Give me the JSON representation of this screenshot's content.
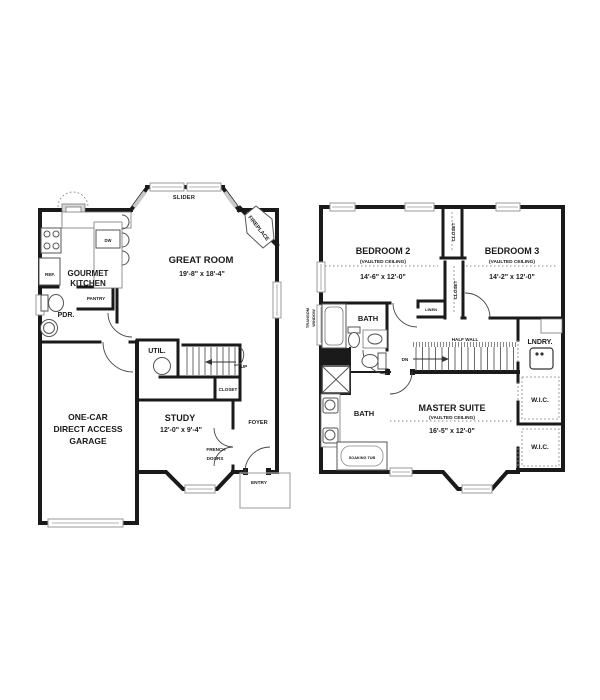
{
  "colors": {
    "wall": "#1a1a1a",
    "window_gray": "#c9c9c9",
    "fixture_gray": "#d9d9d9"
  },
  "floor1": {
    "slider": "SLIDER",
    "fireplace": "FIREPLACE",
    "great_room": {
      "name": "GREAT ROOM",
      "dims": "19'-8\" x 18'-4\""
    },
    "kitchen": {
      "line1": "GOURMET",
      "line2": "KITCHEN"
    },
    "ref": "REF.",
    "dw": "DW",
    "pantry": "PANTRY",
    "pdr": "PDR.",
    "util": "UTIL.",
    "up": "UP",
    "closet": "CLOSET",
    "study": {
      "name": "STUDY",
      "dims": "12'-0\" x 9'-4\""
    },
    "foyer": "FOYER",
    "french_doors": {
      "line1": "FRENCH",
      "line2": "DOORS"
    },
    "entry": "ENTRY",
    "garage": {
      "line1": "ONE-CAR",
      "line2": "DIRECT ACCESS",
      "line3": "GARAGE"
    }
  },
  "floor2": {
    "bedroom2": {
      "name": "BEDROOM 2",
      "ceiling": "(VAULTED CEILING)",
      "dims": "14'-6\" x 12'-0\""
    },
    "bedroom3": {
      "name": "BEDROOM 3",
      "ceiling": "(VAULTED CEILING)",
      "dims": "14'-2\" x 12'-0\""
    },
    "master": {
      "name": "MASTER SUITE",
      "ceiling": "(VAULTED CEILING)",
      "dims": "16'-5\" x 12'-0\""
    },
    "closet1": "CLOSET",
    "closet2": "CLOSET",
    "linen": "LINEN",
    "bath_upper": "BATH",
    "bath_lower": "BATH",
    "half_wall": "HALF WALL",
    "dn": "DN",
    "lndry": "LNDRY.",
    "wic1": "W.I.C.",
    "wic2": "W.I.C.",
    "transom": {
      "line1": "TRANSOM",
      "line2": "WINDOW"
    },
    "soaking_tub": "SOAKING TUB"
  }
}
